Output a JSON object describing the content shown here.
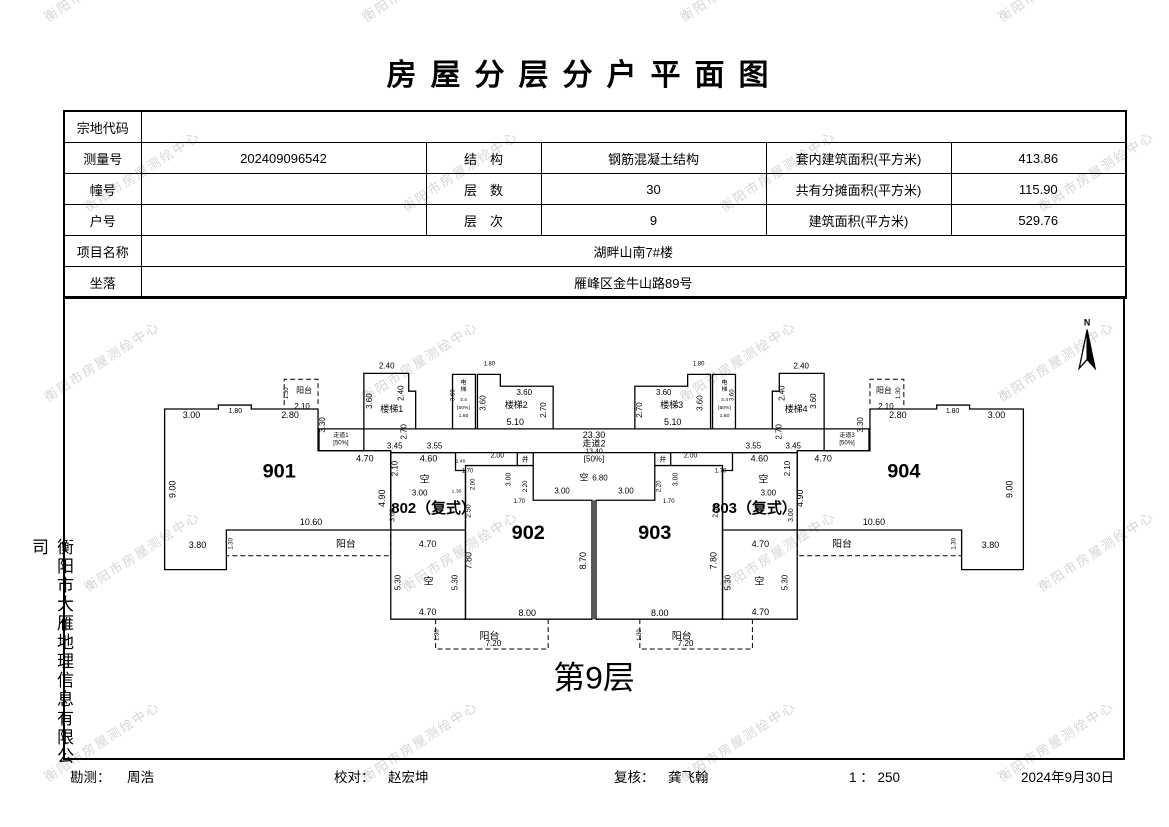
{
  "title": "房屋分层分户平面图",
  "watermark": {
    "text": "衡阳市房屋测绘中心",
    "color": "#c0c0c0"
  },
  "side_company": "衡阳市大雁地理信息有限公司",
  "info_table": {
    "r1": {
      "label": "宗地代码",
      "value": ""
    },
    "r2": {
      "l1": "测量号",
      "v1": "202409096542",
      "l2": "结　构",
      "v2": "钢筋混凝土结构",
      "l3": "套内建筑面积(平方米)",
      "v3": "413.86"
    },
    "r3": {
      "l1": "幢号",
      "v1": "",
      "l2": "层　数",
      "v2": "30",
      "l3": "共有分摊面积(平方米)",
      "v3": "115.90"
    },
    "r4": {
      "l1": "户号",
      "v1": "",
      "l2": "层　次",
      "v2": "9",
      "l3": "建筑面积(平方米)",
      "v3": "529.76"
    },
    "r5": {
      "label": "项目名称",
      "value": "湖畔山南7#楼"
    },
    "r6": {
      "label": "坐落",
      "value": "雁峰区金牛山路89号"
    }
  },
  "footer": {
    "survey_label": "勘测：",
    "survey_name": "周浩",
    "check_label": "校对：",
    "check_name": "赵宏坤",
    "review_label": "复核：",
    "review_name": "龚飞翰",
    "scale": "1 ： 250",
    "date": "2024年9月30日"
  },
  "plan": {
    "floor_caption": "第9层",
    "north_label": "N",
    "line_color": "#000000",
    "shapes": [
      [
        "M163,408 L217,408 L217,404 L250,404 L250,408 L317,408 L317,450 L390,450 L390,530 L225,530 L225,570 L163,570 Z"
      ],
      [
        "M1025,408 L971,408 L971,404 L938,404 L938,408 L871,408 L871,450 L798,450 L798,530 L963,530 L963,570 L1025,570 Z"
      ],
      [
        "M390,452 L455,452 L455,470 L465,470 L465,620 L390,620 Z"
      ],
      [
        "M390,530 L465,530"
      ],
      [
        "M798,452 L733,452 L733,470 L723,470 L723,620 L798,620 Z"
      ],
      [
        "M723,530 L798,530"
      ],
      [
        "M465,465 L533,465 L533,500 L592,500 L592,620 L465,620 Z"
      ],
      [
        "M723,465 L655,465 L655,500 L596,500 L596,620 L723,620 Z"
      ],
      [
        "M594,500 L594,620"
      ],
      [
        "M317,428 L871,428"
      ],
      [
        "M390,452 L798,452"
      ],
      [
        "M318,428 L318,450 L363,450 L363,428"
      ],
      [
        "M870,428 L870,450 L825,450 L825,428"
      ],
      [
        "M363,428 L363,372 L408,372 L408,390 L415,390 L415,428"
      ],
      [
        "M825,428 L825,372 L780,372 L780,390 L773,390 L773,428"
      ],
      [
        "M452,428 L452,373 L475,373 L475,428"
      ],
      [
        "M736,428 L736,373 L713,373 L713,428"
      ],
      [
        "M477,428 L477,373 L500,373 L500,385 L553,385 L553,428"
      ],
      [
        "M711,428 L711,373 L688,373 L688,385 L635,385 L635,428"
      ],
      [
        "M517,465 L517,452 L533,452 L533,465"
      ],
      [
        "M671,465 L671,452 L655,452 L655,465"
      ],
      [
        "M283,404 L283,378 L317,378 L317,404",
        1
      ],
      [
        "M905,404 L905,378 L871,378 L871,404",
        1
      ],
      [
        "M225,530 L225,556 L390,556 L390,530",
        1
      ],
      [
        "M963,530 L963,556 L798,556 L798,530",
        1
      ],
      [
        "M435,620 L435,650 L548,650 L548,620",
        1
      ],
      [
        "M753,620 L753,650 L640,650 L640,620",
        1
      ],
      [
        "M1089,328 L1097,367 L1089,358 Z",
        0,
        "#000000"
      ],
      [
        "M1089,328 L1081,367 L1089,358 Z"
      ]
    ],
    "labels": [
      [
        "3.00",
        190,
        417,
        9
      ],
      [
        "1.80",
        234,
        412,
        7
      ],
      [
        "2.80",
        289,
        417,
        9
      ],
      [
        "阳台",
        303,
        392,
        8
      ],
      [
        "1.30",
        287,
        392,
        6,
        1
      ],
      [
        "2.10",
        301,
        408,
        8
      ],
      [
        "3.30",
        324,
        424,
        8,
        1
      ],
      [
        "9.00",
        174,
        489,
        9,
        1
      ],
      [
        "901",
        278,
        477,
        20,
        0,
        1
      ],
      [
        "3.80",
        196,
        548,
        9
      ],
      [
        "10.60",
        310,
        525,
        9
      ],
      [
        "阳台",
        345,
        547,
        10
      ],
      [
        "1.30",
        231,
        544,
        6,
        1
      ],
      [
        "2.40",
        386,
        367,
        8
      ],
      [
        "2.40",
        403,
        392,
        8,
        1
      ],
      [
        "3.60",
        371,
        400,
        8,
        1
      ],
      [
        "楼梯1",
        391,
        411,
        9
      ],
      [
        "2.70",
        406,
        431,
        8,
        1
      ],
      [
        "3.45",
        394,
        448,
        8
      ],
      [
        "3.55",
        434,
        448,
        8
      ],
      [
        "走道1",
        340,
        436,
        6
      ],
      [
        "[50%]",
        340,
        444,
        6
      ],
      [
        "4.70",
        364,
        461,
        9
      ],
      [
        "4.60",
        428,
        461,
        9
      ],
      [
        "电",
        463,
        383,
        6
      ],
      [
        "梯",
        463,
        390,
        6
      ],
      [
        "3.4",
        463,
        400,
        5
      ],
      [
        "[50%]",
        463,
        408,
        5
      ],
      [
        "1.60",
        463,
        416,
        5
      ],
      [
        "3.60",
        454,
        394,
        6,
        1
      ],
      [
        "1.80",
        489,
        364,
        6
      ],
      [
        "3.60",
        524,
        394,
        8
      ],
      [
        "3.60",
        485,
        402,
        8,
        1
      ],
      [
        "楼梯2",
        516,
        407,
        9
      ],
      [
        "2.70",
        546,
        409,
        8,
        1
      ],
      [
        "5.10",
        515,
        424,
        9
      ],
      [
        "23.30",
        594,
        437,
        9
      ],
      [
        "走道2",
        594,
        446,
        9
      ],
      [
        "13.40",
        594,
        453,
        7
      ],
      [
        "[50%]",
        594,
        461,
        8
      ],
      [
        "空",
        584,
        480,
        9
      ],
      [
        "6.80",
        600,
        480,
        8
      ],
      [
        "2.00",
        497,
        457,
        7
      ],
      [
        "2.00",
        691,
        457,
        7
      ],
      [
        "井",
        525,
        461,
        7
      ],
      [
        "井",
        663,
        461,
        7
      ],
      [
        "3.00",
        510,
        479,
        7,
        1
      ],
      [
        "2.20",
        527,
        486,
        6,
        1
      ],
      [
        "1.70",
        519,
        503,
        6
      ],
      [
        "3.00",
        562,
        493,
        8
      ],
      [
        "3.00",
        626,
        493,
        8
      ],
      [
        "1.70",
        669,
        503,
        6
      ],
      [
        "3.00",
        678,
        479,
        7,
        1
      ],
      [
        "2.20",
        661,
        486,
        6,
        1
      ],
      [
        "3.60",
        664,
        394,
        8
      ],
      [
        "3.60",
        703,
        402,
        8,
        1
      ],
      [
        "楼梯3",
        672,
        407,
        9
      ],
      [
        "2.70",
        642,
        409,
        8,
        1
      ],
      [
        "5.10",
        673,
        424,
        9
      ],
      [
        "1.80",
        699,
        364,
        6
      ],
      [
        "电",
        725,
        383,
        6
      ],
      [
        "梯",
        725,
        390,
        6
      ],
      [
        "3.4",
        725,
        400,
        5
      ],
      [
        "[50%]",
        725,
        408,
        5
      ],
      [
        "1.60",
        725,
        416,
        5
      ],
      [
        "3.60",
        734,
        394,
        6,
        1
      ],
      [
        "2.40",
        802,
        367,
        8
      ],
      [
        "2.40",
        785,
        392,
        8,
        1
      ],
      [
        "3.60",
        817,
        400,
        8,
        1
      ],
      [
        "楼梯4",
        797,
        411,
        9
      ],
      [
        "2.70",
        782,
        431,
        8,
        1
      ],
      [
        "3.45",
        794,
        448,
        8
      ],
      [
        "3.55",
        754,
        448,
        8
      ],
      [
        "走道3",
        848,
        436,
        6
      ],
      [
        "[50%]",
        848,
        444,
        6
      ],
      [
        "4.70",
        824,
        461,
        9
      ],
      [
        "4.60",
        760,
        461,
        9
      ],
      [
        "2.80",
        899,
        417,
        9
      ],
      [
        "1.80",
        954,
        412,
        7
      ],
      [
        "3.00",
        998,
        417,
        9
      ],
      [
        "阳台",
        885,
        392,
        8
      ],
      [
        "1.30",
        901,
        392,
        6,
        1
      ],
      [
        "2.10",
        887,
        408,
        8
      ],
      [
        "3.30",
        864,
        424,
        8,
        1
      ],
      [
        "9.00",
        1014,
        489,
        9,
        1
      ],
      [
        "904",
        905,
        477,
        20,
        0,
        1
      ],
      [
        "3.80",
        992,
        548,
        9
      ],
      [
        "10.60",
        875,
        525,
        9
      ],
      [
        "阳台",
        843,
        547,
        10
      ],
      [
        "1.30",
        957,
        544,
        6,
        1
      ],
      [
        "2.10",
        397,
        468,
        8,
        1
      ],
      [
        "空",
        424,
        482,
        10
      ],
      [
        "4.90",
        384,
        498,
        9,
        1
      ],
      [
        "3.00",
        419,
        495,
        8
      ],
      [
        "802（复式）",
        433,
        513,
        15,
        0,
        1
      ],
      [
        "1.40",
        460,
        462,
        5
      ],
      [
        "1.70",
        467,
        472,
        6
      ],
      [
        "2.00",
        474,
        484,
        6,
        1
      ],
      [
        "1.30",
        456,
        492,
        5
      ],
      [
        "2.50",
        470,
        511,
        7,
        1
      ],
      [
        "3.00",
        394,
        515,
        7,
        1
      ],
      [
        "4.70",
        427,
        547,
        9
      ],
      [
        "5.30",
        400,
        583,
        8,
        1
      ],
      [
        "空",
        428,
        585,
        10
      ],
      [
        "5.30",
        457,
        583,
        8,
        1
      ],
      [
        "7.80",
        471,
        561,
        9,
        1
      ],
      [
        "4.70",
        427,
        616,
        9
      ],
      [
        "2.10",
        791,
        468,
        8,
        1
      ],
      [
        "空",
        764,
        482,
        10
      ],
      [
        "4.90",
        804,
        498,
        9,
        1
      ],
      [
        "3.00",
        769,
        495,
        8
      ],
      [
        "803（复式）",
        755,
        513,
        15,
        0,
        1
      ],
      [
        "1.70",
        721,
        472,
        6
      ],
      [
        "2.50",
        718,
        511,
        7,
        1
      ],
      [
        "3.00",
        794,
        515,
        7,
        1
      ],
      [
        "4.70",
        761,
        547,
        9
      ],
      [
        "5.30",
        788,
        583,
        8,
        1
      ],
      [
        "空",
        760,
        585,
        10
      ],
      [
        "5.30",
        731,
        583,
        8,
        1
      ],
      [
        "7.80",
        717,
        561,
        9,
        1
      ],
      [
        "4.70",
        761,
        616,
        9
      ],
      [
        "902",
        528,
        539,
        20,
        0,
        1
      ],
      [
        "903",
        655,
        539,
        20,
        0,
        1
      ],
      [
        "8.70",
        586,
        561,
        9,
        1
      ],
      [
        "8.00",
        527,
        617,
        9
      ],
      [
        "8.00",
        660,
        617,
        9
      ],
      [
        "阳台",
        489,
        640,
        10
      ],
      [
        "7.20",
        493,
        647,
        8
      ],
      [
        "1.30",
        438,
        636,
        6,
        1
      ],
      [
        "阳台",
        682,
        640,
        10
      ],
      [
        "7.20",
        686,
        647,
        8
      ],
      [
        "1.30",
        641,
        636,
        6,
        1
      ],
      [
        "第9层",
        594,
        690,
        32
      ],
      [
        "N",
        1089,
        324,
        9,
        0,
        1
      ]
    ]
  }
}
